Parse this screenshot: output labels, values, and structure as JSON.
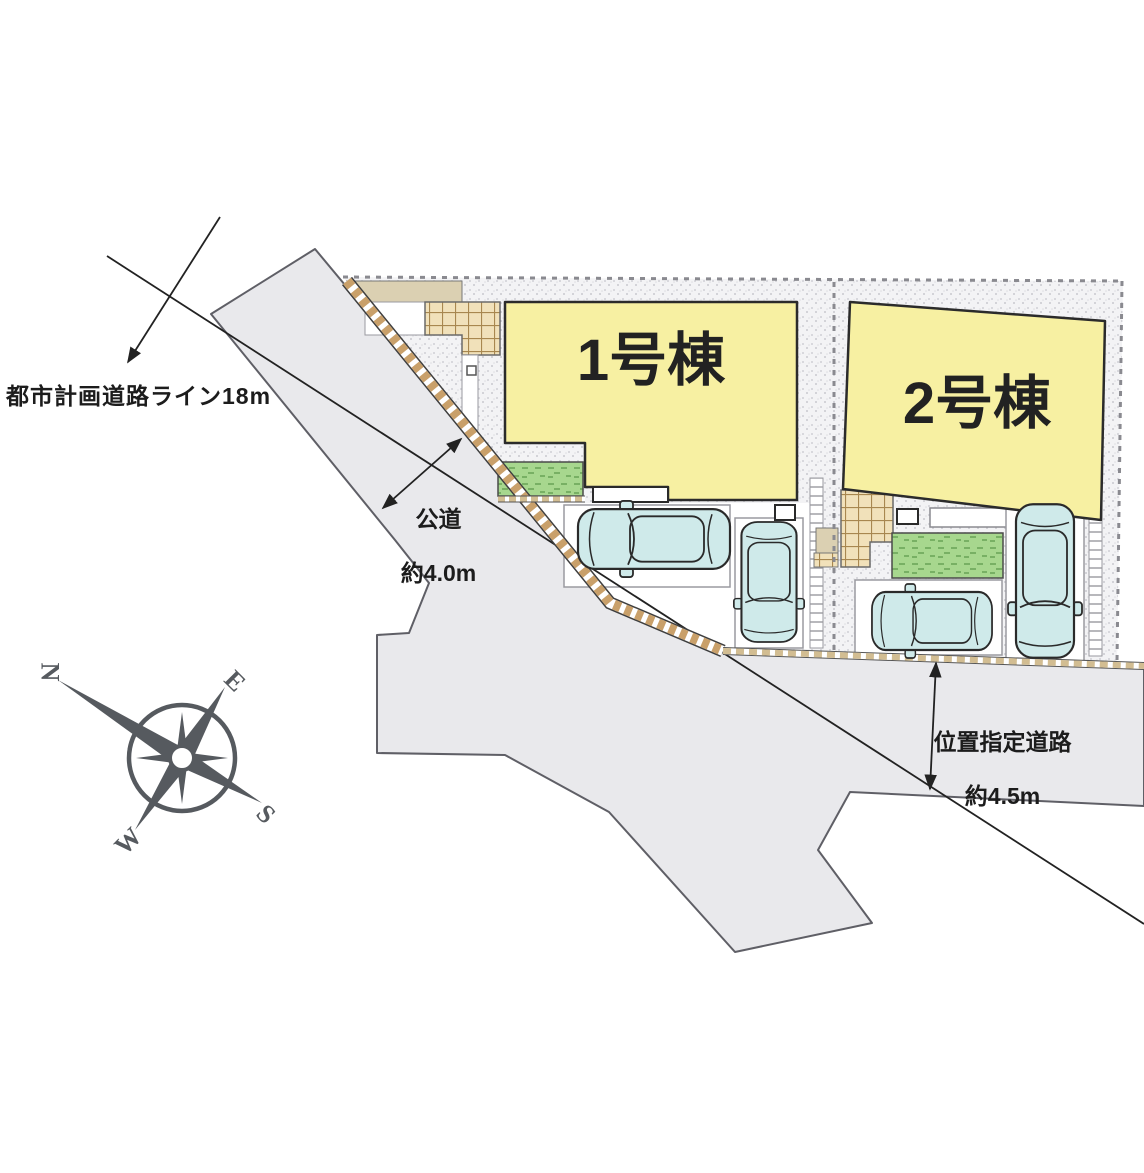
{
  "labels": {
    "planning_line": "都市計画道路ライン18m",
    "public_road_name": "公道",
    "public_road_width": "約4.0m",
    "designated_road_name": "位置指定道路",
    "designated_road_width": "約4.5m"
  },
  "buildings": [
    {
      "label": "1号棟"
    },
    {
      "label": "2号棟"
    }
  ],
  "compass": {
    "north": "N",
    "east": "E",
    "south": "S",
    "west": "W"
  },
  "colors": {
    "building_fill": "#f7f0a2",
    "road_fill": "#e9e9ec",
    "lot_texture": "#f3f3f5",
    "grass": "#a7d78e",
    "tile": "#f1e1ba",
    "car": "#cfeaea",
    "curb": "#c9a06a",
    "compass": "#565a5f",
    "line": "#222222"
  }
}
